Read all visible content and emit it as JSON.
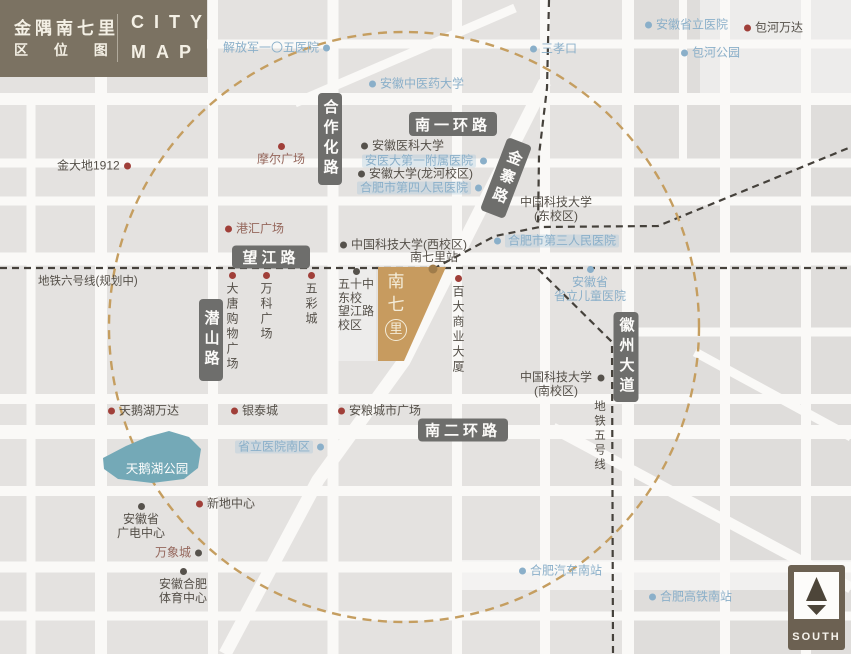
{
  "header": {
    "project_name": "金隅南七里",
    "map_type": "区 位 图",
    "brand_line1": "CITY",
    "brand_line2": "MAP"
  },
  "project": {
    "name": "南七里",
    "chars": [
      "南",
      "七",
      "里"
    ]
  },
  "compass": {
    "label": "SOUTH"
  },
  "colors": {
    "accent_gold": "#c59e60",
    "project_fill": "#c79b5f",
    "park_fill": "#74a9b7",
    "blue_text": "#8aafc9",
    "red_dot": "#a03f39",
    "header_bg": "#7b7262",
    "road_label_bg": "#6e6e6c",
    "metro_dash": "#45413b"
  },
  "road_labels": [
    {
      "id": "road-label-hezuohua-rd",
      "text": "合作化路",
      "orient": "v",
      "x": 330,
      "y": 139,
      "w": 24,
      "h": 92,
      "rot": 0
    },
    {
      "id": "road-label-south-1st-ring-rd",
      "text": "南一环路",
      "orient": "h",
      "x": 453,
      "y": 124,
      "w": 88,
      "h": 24,
      "rot": 0
    },
    {
      "id": "road-label-jinzhai-rd",
      "text": "金寨路",
      "orient": "v",
      "x": 506,
      "y": 178,
      "w": 26,
      "h": 78,
      "rot": 21
    },
    {
      "id": "road-label-wangjiang-rd",
      "text": "望江路",
      "orient": "h",
      "x": 271,
      "y": 257,
      "w": 78,
      "h": 23,
      "rot": 0
    },
    {
      "id": "road-label-qianshan-rd",
      "text": "潜山路",
      "orient": "v",
      "x": 211,
      "y": 340,
      "w": 24,
      "h": 82,
      "rot": 0
    },
    {
      "id": "road-label-huizhou-ave",
      "text": "徽州大道",
      "orient": "v",
      "x": 626,
      "y": 357,
      "w": 25,
      "h": 90,
      "rot": 0
    },
    {
      "id": "road-label-south-2nd-ring-rd",
      "text": "南二环路",
      "orient": "h",
      "x": 463,
      "y": 430,
      "w": 90,
      "h": 23,
      "rot": 0
    }
  ],
  "pois": [
    {
      "id": "pla-105-hospital",
      "name": "解放军一〇五医院",
      "color": "blue",
      "dot": "blue",
      "dot_pos": "r",
      "orient": "h",
      "x": 223,
      "y": 48
    },
    {
      "id": "sanxiaokou",
      "name": "三孝口",
      "color": "blue",
      "dot": "blue",
      "dot_pos": "l",
      "orient": "h",
      "x": 530,
      "y": 49
    },
    {
      "id": "anhui-provincial-hospital",
      "name": "安徽省立医院",
      "color": "blue",
      "dot": "blue",
      "dot_pos": "l",
      "orient": "h",
      "x": 645,
      "y": 25
    },
    {
      "id": "baohe-wanda",
      "name": "包河万达",
      "color": "dark",
      "dot": "red",
      "dot_pos": "l",
      "orient": "h",
      "x": 744,
      "y": 28
    },
    {
      "id": "baohe-park",
      "name": "包河公园",
      "color": "blue",
      "dot": "blue",
      "dot_pos": "l",
      "orient": "h",
      "x": 681,
      "y": 53
    },
    {
      "id": "anhui-tcm-university",
      "name": "安徽中医药大学",
      "color": "blue",
      "dot": "blue",
      "dot_pos": "l",
      "orient": "h",
      "x": 369,
      "y": 84
    },
    {
      "id": "jindadi-1912",
      "name": "金大地1912",
      "color": "dark",
      "dot": "red",
      "dot_pos": "r",
      "orient": "h",
      "x": 57,
      "y": 166
    },
    {
      "id": "moer-plaza",
      "name": "摩尔广场",
      "color": "brown",
      "dot": "red",
      "dot_pos": "t",
      "orient": "h",
      "x": 281,
      "y": 143,
      "center": true
    },
    {
      "id": "ganghui-plaza",
      "name": "港汇广场",
      "color": "brown",
      "dot": "red",
      "dot_pos": "l",
      "orient": "h",
      "x": 225,
      "y": 229
    },
    {
      "id": "anhui-medical-university",
      "name": "安徽医科大学",
      "color": "dark",
      "dot": "dark",
      "dot_pos": "l",
      "orient": "h",
      "x": 361,
      "y": 146
    },
    {
      "id": "anyida-first-affiliated-hospital",
      "name": "安医大第一附属医院",
      "color": "blue",
      "dot": "blue",
      "dot_pos": "r",
      "orient": "h",
      "x": 362,
      "y": 161,
      "bg": true
    },
    {
      "id": "anhui-university-longhe-campus",
      "name": "安徽大学(龙河校区)",
      "color": "dark",
      "dot": "dark",
      "dot_pos": "l",
      "orient": "h",
      "x": 358,
      "y": 174
    },
    {
      "id": "hefei-4th-peoples-hospital",
      "name": "合肥市第四人民医院",
      "color": "blue",
      "dot": "blue",
      "dot_pos": "r",
      "orient": "h",
      "x": 357,
      "y": 188,
      "bg": true
    },
    {
      "id": "ustc-east-campus",
      "lines": [
        "中国科技大学",
        "(东校区)"
      ],
      "color": "dark",
      "dot_pos": "n",
      "orient": "h",
      "x": 556,
      "y": 196,
      "center": true
    },
    {
      "id": "hefei-3rd-peoples-hospital",
      "name": "合肥市第三人民医院",
      "color": "blue",
      "dot": "blue",
      "dot_pos": "l",
      "orient": "h",
      "x": 494,
      "y": 241,
      "bg": true
    },
    {
      "id": "ustc-west-campus",
      "name": "中国科技大学(西校区)",
      "color": "dark",
      "dot": "dark",
      "dot_pos": "l",
      "orient": "h",
      "x": 340,
      "y": 245
    },
    {
      "id": "nanqili-station-label",
      "name": "南七里站",
      "color": "dark",
      "dot_pos": "n",
      "orient": "h",
      "x": 434,
      "y": 251,
      "center": true
    },
    {
      "id": "provincial-childrens-hospital",
      "lines": [
        "安徽省",
        "省立儿童医院"
      ],
      "color": "blue",
      "dot": "blue",
      "dot_pos": "t",
      "orient": "h",
      "x": 590,
      "y": 266,
      "center": true
    },
    {
      "id": "datang-shopping-plaza",
      "name": "大唐购物广场",
      "color": "dark",
      "dot": "red",
      "dot_pos": "t",
      "orient": "v",
      "x": 232,
      "y": 272,
      "center": true
    },
    {
      "id": "vanke-plaza",
      "name": "万科广场",
      "color": "dark",
      "dot": "red",
      "dot_pos": "t",
      "orient": "v",
      "x": 266,
      "y": 272,
      "center": true
    },
    {
      "id": "wucai-city",
      "name": "五彩城",
      "color": "dark",
      "dot": "red",
      "dot_pos": "t",
      "orient": "v",
      "x": 311,
      "y": 272,
      "center": true
    },
    {
      "id": "no50-middle-school-east",
      "lines": [
        "五十中",
        "东校",
        "望江路",
        "校区"
      ],
      "color": "dark",
      "dot": "dark",
      "dot_pos": "t",
      "orient": "h",
      "x": 356,
      "y": 268,
      "center": true,
      "align": "left"
    },
    {
      "id": "baida-commercial-building",
      "name": "百大商业大厦",
      "color": "dark",
      "dot": "red",
      "dot_pos": "t",
      "orient": "v",
      "x": 458,
      "y": 275,
      "center": true
    },
    {
      "id": "ustc-south-campus",
      "lines": [
        "中国科技大学",
        "(南校区)"
      ],
      "color": "dark",
      "dot_pos": "n",
      "orient": "h",
      "x": 556,
      "y": 371,
      "center": true
    },
    {
      "id": "ustc-south-campus-dot",
      "color": "dark",
      "dot": "dark",
      "dot_pos": "only",
      "orient": "h",
      "x": 601,
      "y": 378
    },
    {
      "id": "swan-lake-wanda",
      "name": "天鹅湖万达",
      "color": "dark",
      "dot": "red",
      "dot_pos": "l",
      "orient": "h",
      "x": 108,
      "y": 411
    },
    {
      "id": "yintai-city",
      "name": "银泰城",
      "color": "dark",
      "dot": "red",
      "dot_pos": "l",
      "orient": "h",
      "x": 231,
      "y": 411
    },
    {
      "id": "anliang-city-plaza",
      "name": "安粮城市广场",
      "color": "dark",
      "dot": "red",
      "dot_pos": "l",
      "orient": "h",
      "x": 338,
      "y": 411
    },
    {
      "id": "provincial-hospital-south",
      "name": "省立医院南区",
      "color": "blue",
      "dot": "blue",
      "dot_pos": "r",
      "orient": "h",
      "x": 235,
      "y": 447,
      "bg": true
    },
    {
      "id": "swan-lake-park-label",
      "name": "天鹅湖公园",
      "color": "white",
      "dot_pos": "n",
      "orient": "h",
      "x": 157,
      "y": 463,
      "center": true,
      "size": 12.5
    },
    {
      "id": "xindi-center",
      "name": "新地中心",
      "color": "dark",
      "dot": "red",
      "dot_pos": "l",
      "orient": "h",
      "x": 196,
      "y": 504
    },
    {
      "id": "anhui-broadcast-center",
      "lines": [
        "安徽省",
        "广电中心"
      ],
      "color": "dark",
      "dot": "dark",
      "dot_pos": "t",
      "orient": "h",
      "x": 141,
      "y": 503,
      "center": true
    },
    {
      "id": "mixc-mall",
      "name": "万象城",
      "color": "brown",
      "dot": "dark",
      "dot_pos": "r",
      "orient": "h",
      "x": 155,
      "y": 553
    },
    {
      "id": "anhui-hefei-sports-center",
      "lines": [
        "安徽合肥",
        "体育中心"
      ],
      "color": "dark",
      "dot": "dark",
      "dot_pos": "t",
      "orient": "h",
      "x": 183,
      "y": 568,
      "center": true
    },
    {
      "id": "hefei-south-bus-station",
      "name": "合肥汽车南站",
      "color": "blue",
      "dot": "blue",
      "dot_pos": "l",
      "orient": "h",
      "x": 519,
      "y": 571
    },
    {
      "id": "hefei-south-railway-station",
      "name": "合肥高铁南站",
      "color": "blue",
      "dot": "blue",
      "dot_pos": "l",
      "orient": "h",
      "x": 649,
      "y": 597
    },
    {
      "id": "metro-line-6-label",
      "name": "地铁六号线(规划中)",
      "color": "dark",
      "dot_pos": "n",
      "orient": "h",
      "x": 38,
      "y": 282,
      "size": 11.5
    },
    {
      "id": "metro-line-5-label",
      "name": "地铁五号线",
      "color": "dark",
      "dot_pos": "n",
      "orient": "v",
      "x": 599,
      "y": 400,
      "center": true,
      "size": 11.5
    }
  ]
}
